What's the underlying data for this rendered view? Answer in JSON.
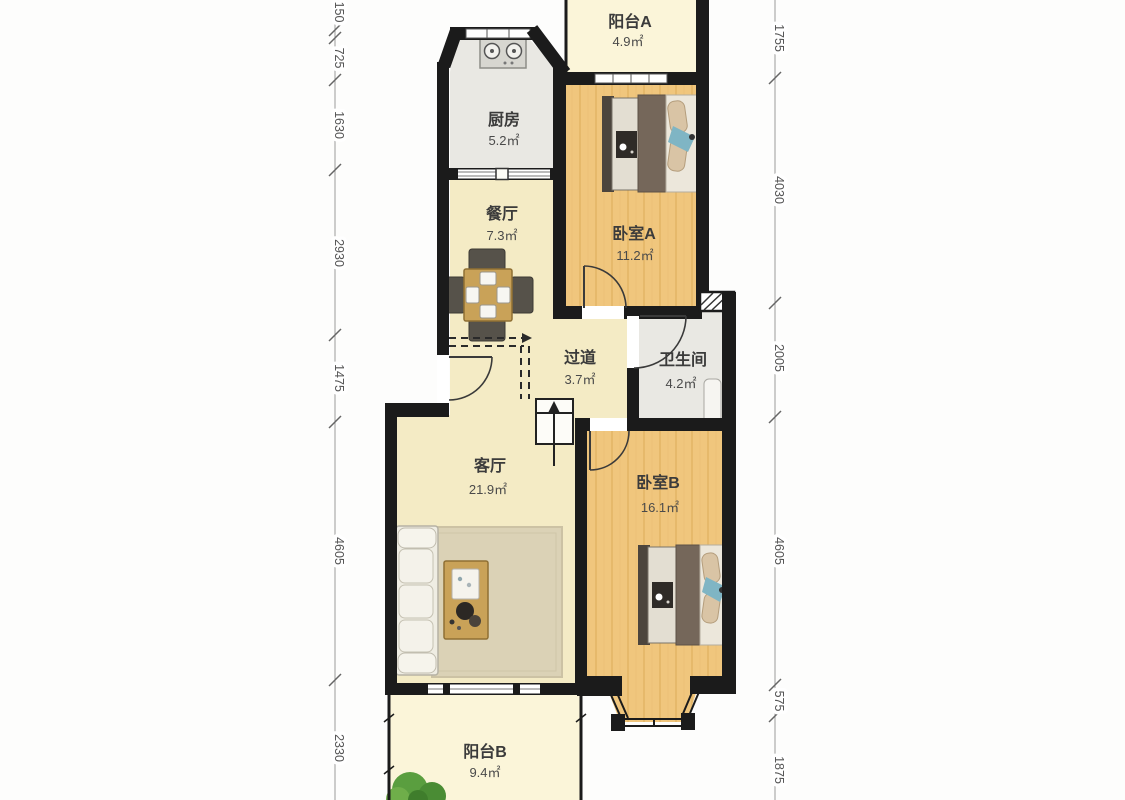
{
  "rooms": {
    "balcony_a": {
      "name": "阳台A",
      "area": "4.9㎡"
    },
    "kitchen": {
      "name": "厨房",
      "area": "5.2㎡"
    },
    "dining": {
      "name": "餐厅",
      "area": "7.3㎡"
    },
    "bedroom_a": {
      "name": "卧室A",
      "area": "11.2㎡"
    },
    "hallway": {
      "name": "过道",
      "area": "3.7㎡"
    },
    "bathroom": {
      "name": "卫生间",
      "area": "4.2㎡"
    },
    "living": {
      "name": "客厅",
      "area": "21.9㎡"
    },
    "bedroom_b": {
      "name": "卧室B",
      "area": "16.1㎡"
    },
    "balcony_b": {
      "name": "阳台B",
      "area": "9.4㎡"
    }
  },
  "dimensions": {
    "left": [
      "150",
      "725",
      "1630",
      "2930",
      "1475",
      "4605",
      "2330"
    ],
    "right": [
      "1755",
      "4030",
      "2005",
      "4605",
      "575",
      "1875"
    ]
  },
  "colors": {
    "wall": "#1b1b1b",
    "floor_main": "#f4ebc5",
    "floor_bedroom": "#f0c67d",
    "floor_bedroom_stripe": "#e6b96b",
    "floor_balcony": "#fbf5d9",
    "floor_wet": "#e9e8e3",
    "rug": "#dbd2b6",
    "wood_furniture": "#c9a258",
    "accent_blue": "#7fb5c4",
    "plant_green": "#5a9e3f",
    "dim_text": "#555555"
  }
}
